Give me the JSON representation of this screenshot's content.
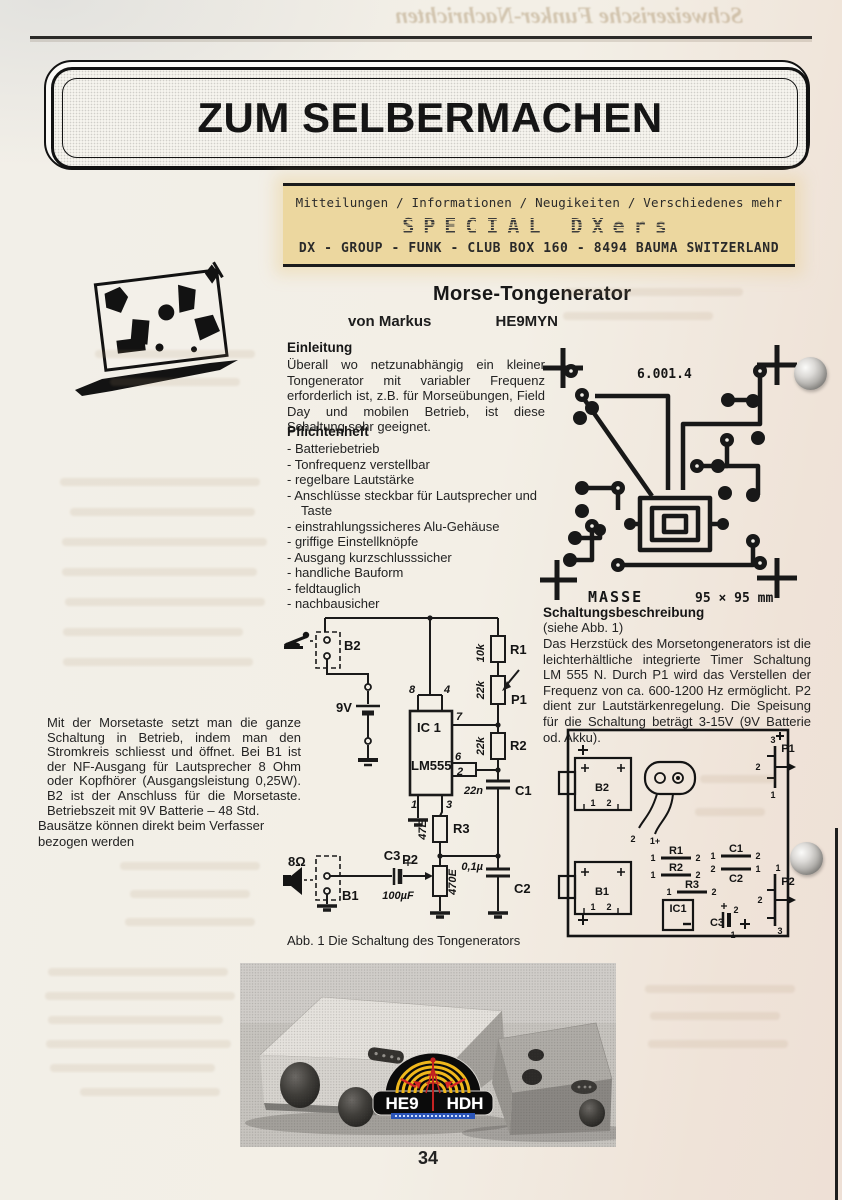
{
  "page": {
    "number": "34",
    "ghost_title": "Schweizerische Funker-Nachrichten"
  },
  "masthead": {
    "title": "ZUM SELBERMACHEN"
  },
  "club_banner": {
    "line1": "Mitteilungen / Informationen / Neugikeiten / Verschiedenes mehr",
    "line2": "SPECIAL DXers",
    "line3": "DX - GROUP - FUNK - CLUB  BOX 160 - 8494 BAUMA  SWITZERLAND"
  },
  "article": {
    "title": "Morse-Tongenerator",
    "byline_prefix": "von Markus",
    "callsign": "HE9MYN",
    "einleitung_heading": "Einleitung",
    "einleitung_body": "Überall wo netzunabhängig ein kleiner Tongenerator mit variabler Frequenz erforderlich ist, z.B. für Morseübungen, Field Day und mobilen Betrieb, ist diese Schaltung sehr geeignet.",
    "pflichtenheft_heading": "Pflichtenheft",
    "pflichtenheft_items": [
      "Batteriebetrieb",
      "Tonfrequenz verstellbar",
      "regelbare Lautstärke",
      "Anschlüsse steckbar für Lautsprecher und Taste",
      "einstrahlungssicheres Alu-Gehäuse",
      "griffige Einstellknöpfe",
      "Ausgang kurzschlusssicher",
      "handliche Bauform",
      "feldtauglich",
      "nachbausicher"
    ],
    "betrieb_body": "Mit der Morsetaste setzt man die ganze Schaltung in Betrieb, indem man den Stromkreis schliesst und öffnet. Bei B1 ist der NF-Ausgang für Lautsprecher 8 Ohm oder Kopfhörer (Ausgangsleistung 0,25W). B2 ist der Anschluss für die Morsetaste. Betriebszeit mit 9V Batterie – 48 Std.",
    "bausatz_note": "Bausätze können direkt beim Verfasser bezogen werden",
    "beschreibung_heading": "Schaltungsbeschreibung",
    "beschreibung_sub": "(siehe Abb. 1)",
    "beschreibung_body": "Das Herzstück des Morsetongenerators ist die leichterhältliche integrierte Timer Schaltung LM 555 N. Durch P1 wird das Verstellen der Frequenz von ca. 600-1200 Hz ermöglicht. P2 dient zur Lautstärkenregelung. Die Speisung für die Schaltung beträgt 3-15V (9V Batterie od. Akku).",
    "abb1_caption": "Abb. 1 Die Schaltung des Tongenerators"
  },
  "pcb": {
    "part_number": "6.001.4",
    "ground_label": "MASSE",
    "dimensions": "95 × 95 mm"
  },
  "schematic": {
    "b2": "B2",
    "battery": "9V",
    "ic_ref": "IC 1",
    "ic_type": "LM555",
    "pin8": "8",
    "pin4": "4",
    "pin7": "7",
    "pin6": "6",
    "pin2": "2",
    "pin1": "1",
    "pin3": "3",
    "r1": "R1",
    "r1_val": "10k",
    "p1": "P1",
    "p1_val": "22k",
    "r2": "R2",
    "r2_val": "22k",
    "c1": "C1",
    "c1_val": "22n",
    "r3": "R3",
    "r3_val": "47E",
    "p2": "P2",
    "p2_val": "470E",
    "c2": "C2",
    "c2_val": "0,1µ",
    "c3": "C3",
    "c3_val": "100µF",
    "b1": "B1",
    "speaker": "8Ω"
  },
  "layout": {
    "b2": "B2",
    "b1": "B1",
    "ic1": "IC1",
    "p1": "P1",
    "p2": "P2",
    "r1": "R1",
    "r2": "R2",
    "r3": "R3",
    "c1": "C1",
    "c2": "C2",
    "c3": "C3",
    "pad2": "2",
    "pad1": "1+",
    "pin1": "1",
    "pin2": "2",
    "pin3": "3"
  },
  "logo": {
    "left": "HE9",
    "right": "HDH"
  }
}
